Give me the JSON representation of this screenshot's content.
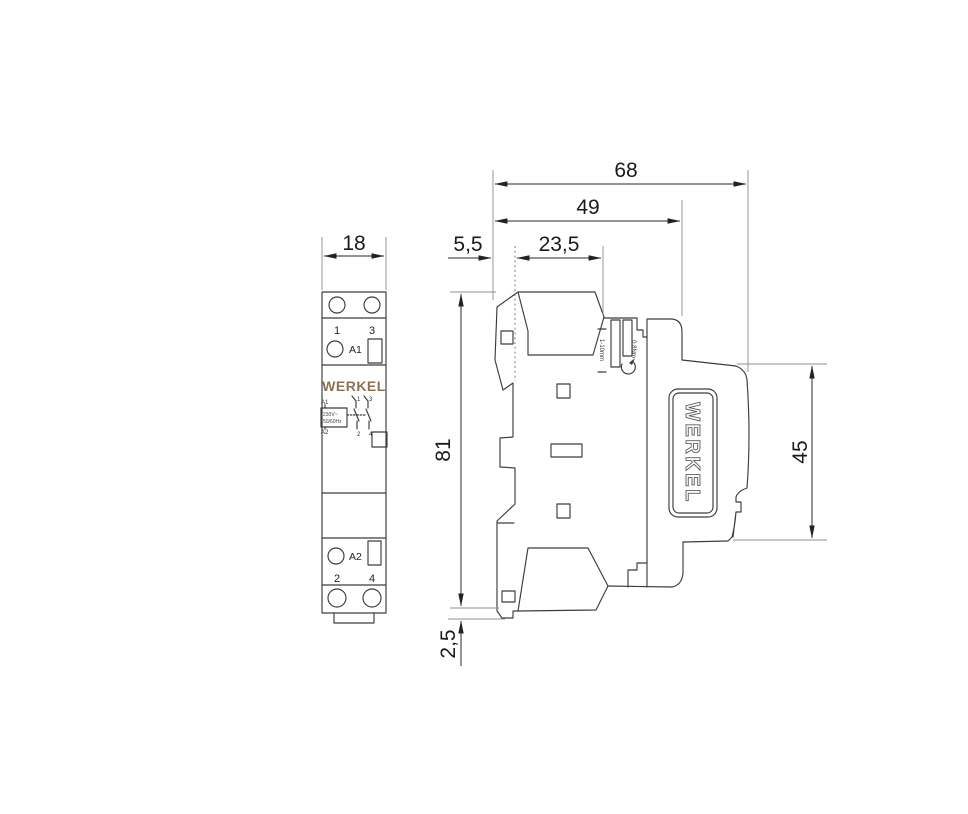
{
  "drawing": {
    "title_brand": "WERKEL",
    "colors": {
      "line": "#3c3c3c",
      "dimension_text": "#1a1a1a",
      "brand_gold": "#8d7356",
      "background": "#ffffff"
    },
    "dimensions": {
      "front_width": "18",
      "total_depth": "68",
      "body_depth": "49",
      "front_offset": "5,5",
      "front_section_depth": "23,5",
      "body_height": "81",
      "din_height": "45",
      "clip_offset": "2,5"
    },
    "front_view": {
      "terminal_labels_top": [
        "1",
        "3"
      ],
      "coil_label_top": "A1",
      "coil_label_bottom": "A2",
      "terminal_labels_bottom": [
        "2",
        "4"
      ],
      "logo": "WERKEL",
      "schematic": {
        "coil_a1": "A1",
        "coil_a2": "A2",
        "rating_line1": "230V~",
        "rating_line2": "50/60Hz",
        "contact_labels_top": [
          "1",
          "3"
        ],
        "contact_labels_bottom": [
          "2",
          "4"
        ]
      }
    },
    "side_view": {
      "plate_logo": "WERKEL",
      "strip_length_label": "1-10mm",
      "torque_label": "0.8Nm"
    }
  }
}
